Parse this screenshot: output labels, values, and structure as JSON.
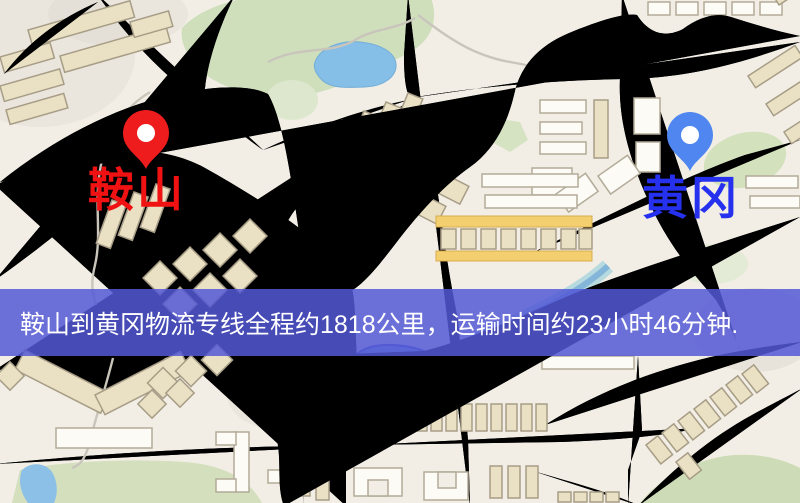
{
  "map": {
    "origin": {
      "label": "鞍山",
      "label_color": "#f01212",
      "pin_color": "#ee1c1c"
    },
    "destination": {
      "label": "黄冈",
      "label_color": "#2531ee",
      "pin_color": "#5086ef"
    },
    "palette": {
      "background": "#f2eee5",
      "road_fill": "#f8d87f",
      "road_casing": "#e9b85a",
      "minor_road_fill": "#fdf3d4",
      "water": "#85bee6",
      "park": "#cfdfbc",
      "railway": "#3c3c3c",
      "building": "#eae1c4",
      "banner": "#5458d6"
    },
    "icons": [
      "origin-pin-icon",
      "destination-pin-icon"
    ]
  },
  "banner": {
    "text": "鞍山到黄冈物流专线全程约1818公里，运输时间约23小时46分钟.",
    "text_color": "#ffffff"
  },
  "route": {
    "origin": "鞍山",
    "destination": "黄冈",
    "distance_km": "1818",
    "duration": "23小时46分钟"
  }
}
